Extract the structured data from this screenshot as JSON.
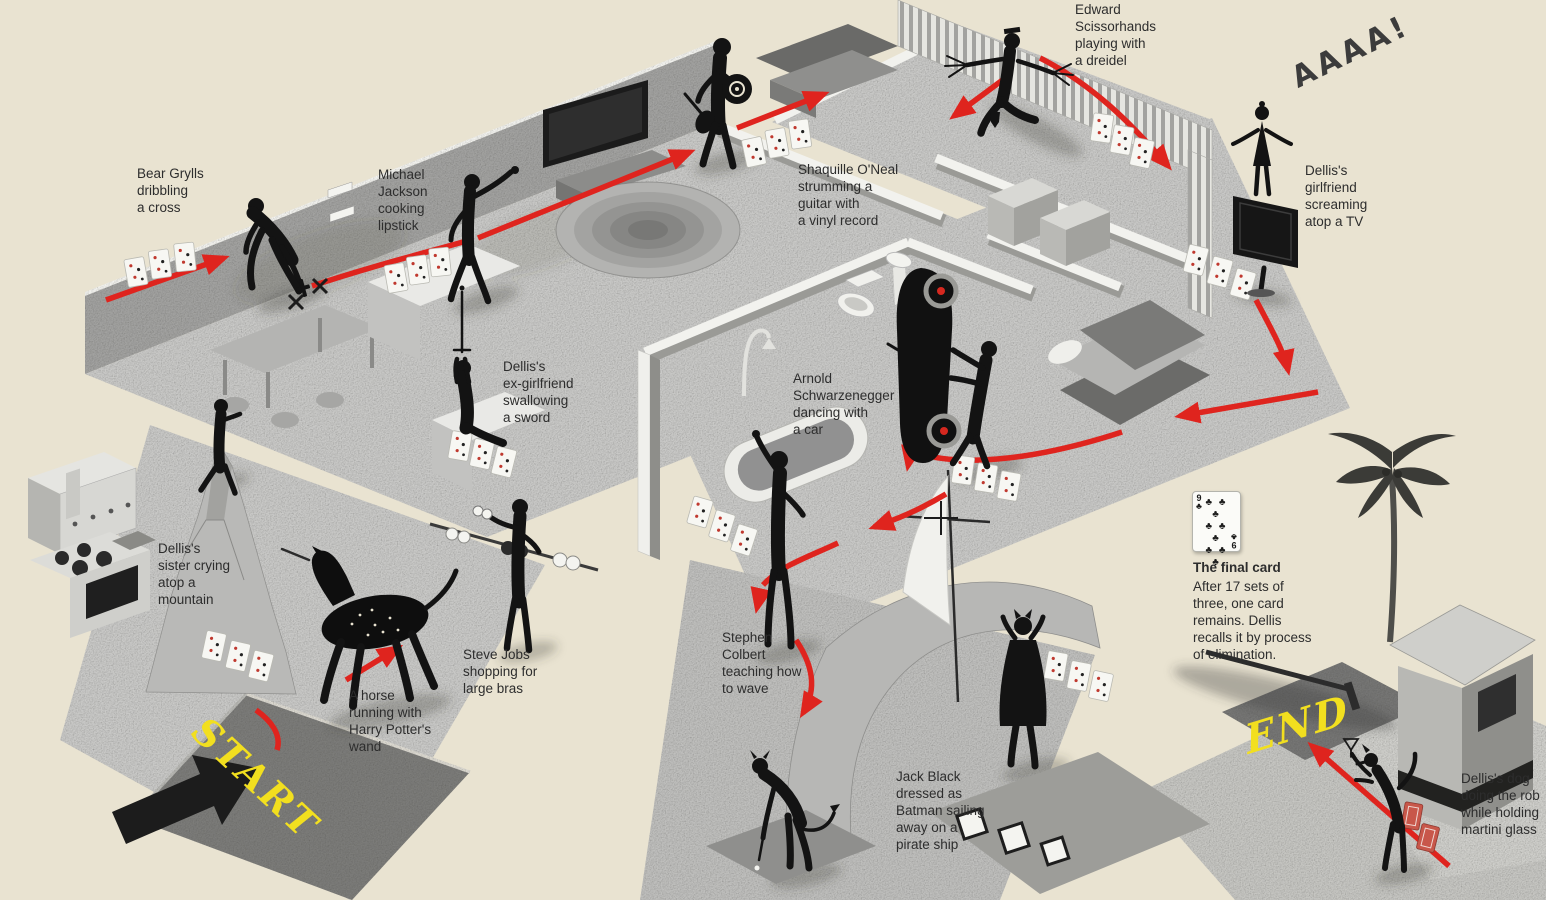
{
  "document": {
    "type": "isometric memory-palace infographic",
    "subject": "Walkthrough of a house used to memorize a deck of cards"
  },
  "colors": {
    "background": "#e9e3d1",
    "floor_gray": "#c9c9c7",
    "wall_gray": "#a2a2a0",
    "path_red": "#df241e",
    "marker_yellow": "#f2df1f",
    "ink": "#2d2d2d"
  },
  "path": {
    "start_label": "START",
    "end_label": "END"
  },
  "annotations": {
    "bear_grylls": "Bear Grylls\ndribbling\na cross",
    "michael_jackson": "Michael\nJackson\ncooking\nlipstick",
    "shaquille_oneal": "Shaquille O'Neal\nstrumming a\nguitar with\na vinyl record",
    "edward_scissorhands": "Edward\nScissorhands\nplaying with\na dreidel",
    "scream": "AAAA!",
    "girlfriend": "Dellis's\ngirlfriend\nscreaming\natop a TV",
    "ex_girlfriend": "Dellis's\nex-girlfriend\nswallowing\na sword",
    "arnold": "Arnold\nSchwarzenegger\ndancing with\na car",
    "sister": "Dellis's\nsister crying\natop a\nmountain",
    "steve_jobs": "Steve Jobs\nshopping for\nlarge bras",
    "horse": "A horse\nrunning with\nHarry Potter's\nwand",
    "stephen_colbert": "Stephen\nColbert\nteaching how\nto wave",
    "jack_black": "Jack Black\ndressed as\nBatman sailing\naway on a\npirate ship",
    "dog": "Dellis's dog\ndoing the rob\nwhile holding\nmartini glass"
  },
  "final_card": {
    "title": "The final card",
    "body": "After 17 sets of\nthree, one card\nremains. Dellis\nrecalls it by process\nof elimination.",
    "rank": "9",
    "suit": "♣",
    "pips": "♣ ♣ ♣\n♣ ♣ ♣\n♣ ♣ ♣"
  }
}
